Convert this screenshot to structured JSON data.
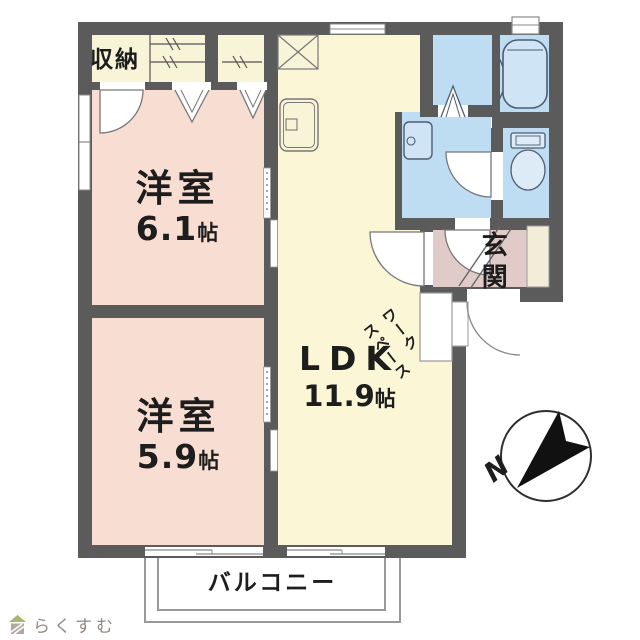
{
  "floorplan": {
    "rooms": {
      "closet": {
        "label": "収納"
      },
      "bedroom1": {
        "label": "洋室",
        "size": "6.1",
        "size_unit": "帖"
      },
      "bedroom2": {
        "label": "洋室",
        "size": "5.9",
        "size_unit": "帖"
      },
      "ldk": {
        "label": "LDK",
        "size": "11.9",
        "size_unit": "帖"
      },
      "entrance": {
        "label": "玄関"
      },
      "workspace": {
        "label": "ワークスペース",
        "line1": "ワーク",
        "line2": "スペース"
      },
      "balcony": {
        "label": "バルコニー"
      }
    },
    "compass": {
      "north_label": "N"
    },
    "colors": {
      "wall": "#5b5b5b",
      "bedroom_floor": "#f8ded2",
      "ldk_floor": "#faf6d6",
      "closet_floor": "#f8f4d8",
      "sanitary_floor": "#bedcf2",
      "fixture_fill": "#cfe4f5",
      "entrance_floor": "#e0cbc9",
      "cabinet_fill": "#f2edd7",
      "fixture_stroke": "#4e5d73",
      "compass_ink": "#1a1a1a",
      "logo_text_color": "#928880",
      "logo_roof_green": "#a9b567"
    }
  },
  "branding": {
    "logo_text": "らくすむ"
  }
}
